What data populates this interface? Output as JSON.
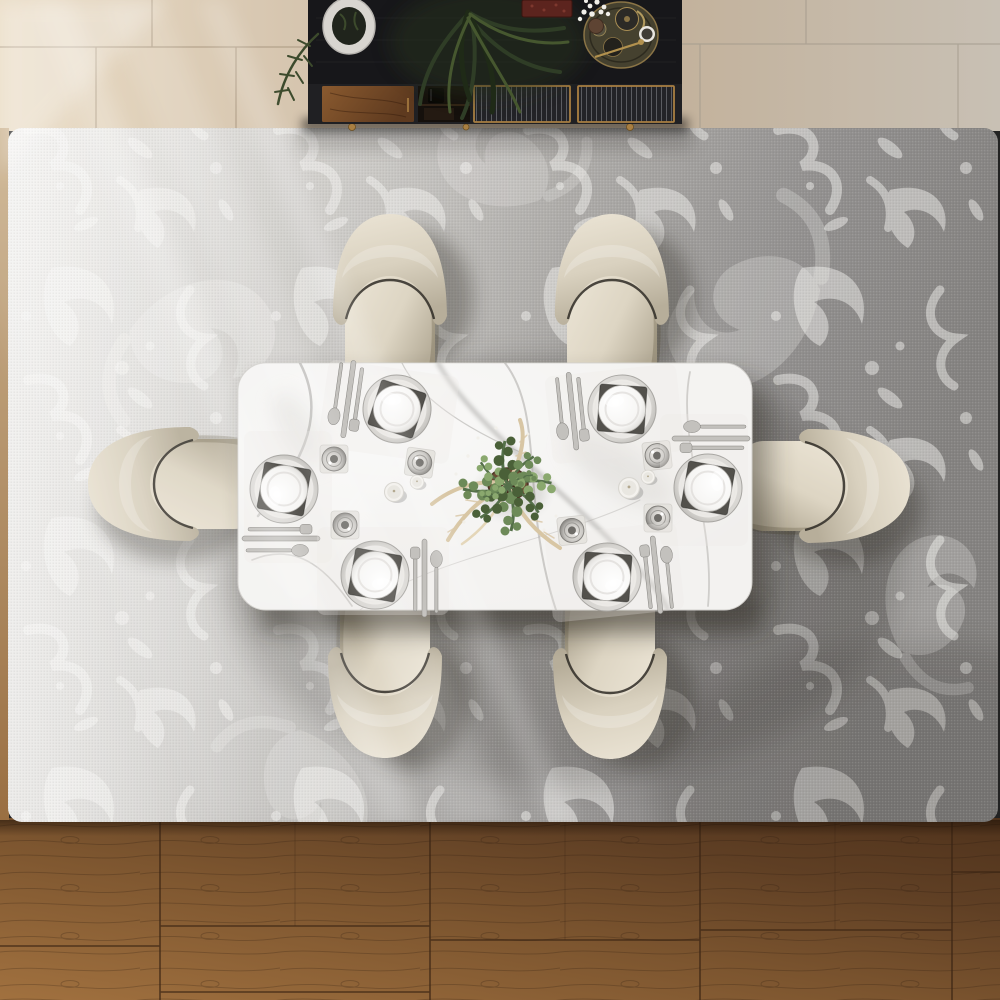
{
  "scene": {
    "description": "Overhead render of a six-seat dining set with a white marble table on a gray damask rug",
    "room": "dining room",
    "view": "top-down",
    "lighting": "diagonal sunbeams entering from the upper left"
  },
  "furniture": {
    "table": {
      "material": "white marble",
      "shape": "rounded rectangle"
    },
    "chairs": {
      "count": 6,
      "upholstery": "cream leather",
      "positions": [
        "top-left",
        "top-right",
        "right",
        "bottom-right",
        "bottom-left",
        "left"
      ]
    },
    "sideboard": {
      "finish": "black wood",
      "details": [
        "walnut cabinet door",
        "open shelf with bottle",
        "two ribbed glass doors",
        "brass trim",
        "brass feet"
      ]
    }
  },
  "decor": {
    "sideboard_top": [
      "white planter with dark plant",
      "palm fronds",
      "round brass tray",
      "glass teapot",
      "ceramic cup",
      "small bowl",
      "brass spoon",
      "white flower posy",
      "red box"
    ],
    "centerpiece": [
      "eucalyptus sprigs",
      "dried pampas stems",
      "wooden vessel",
      "white seed sprays"
    ],
    "candles": {
      "count": 4
    }
  },
  "place_settings": {
    "count": 6,
    "items": [
      "silver charger plate",
      "white underplate",
      "dark gray napkin",
      "white bowl",
      "knife",
      "fork",
      "spoon",
      "glass tumbler",
      "coaster"
    ]
  },
  "rug": {
    "style": "damask floral",
    "texture": "woven",
    "shading": "light washed left, deep gray right"
  },
  "floors": {
    "top": "pale oak planks",
    "bottom": "dark walnut parquet",
    "left_sliver": "oak"
  },
  "palette": {
    "floor_top_a": "#eadcc5",
    "floor_top_b": "#d2c1ab",
    "floor_top_c": "#c3b29c",
    "floor_top_d": "#c8c0b4",
    "floor_bot_a": "#a1713f",
    "floor_bot_b": "#7c552f",
    "floor_bot_c": "#5f3f24",
    "floor_bot_d": "#50331c",
    "floor_seam": "#3a2413",
    "sliver_a": "#cdb592",
    "sliver_b": "#9a6f42",
    "rug_a": "#eae8e4",
    "rug_b": "#cfcdc9",
    "rug_c": "#b0aeab",
    "rug_d": "#939190",
    "rug_e": "#858381",
    "rug_motif": "#f4f3f0",
    "table_marble": "#f3f2f0",
    "marble_vein": "#a3a19e",
    "chair_light": "#ece5d6",
    "chair_mid": "#d9d1bf",
    "chair_dark": "#b7ae9a",
    "chair_seam": "#2e2a24",
    "shadow": "#332f28",
    "napkin": "#53514c",
    "underplate": "#edebe8",
    "charger": "#d6d4d0",
    "bowl_a": "#ffffff",
    "bowl_b": "#f6f5f3",
    "bowl_c": "#d3d1cd",
    "metal": "#c3c1bd",
    "metal_edge": "#85837f",
    "glass_core": "#6e6c68",
    "coaster": "#e4e2dd",
    "candle": "#f4f2ee",
    "green_dark": "#4a6038",
    "green_mid": "#6d8a58",
    "green_light": "#8aa86e",
    "dried": "#d8c6a4",
    "pot": "#6b4a33",
    "palm": "#2f3d26",
    "palm_light": "#46572f",
    "cabinet_top": "#17171a",
    "cabinet_face": "#202023",
    "wood_a": "#8a5a2f",
    "wood_b": "#5e3a1f",
    "brass": "#a97f42",
    "glass_door": "#232327"
  }
}
